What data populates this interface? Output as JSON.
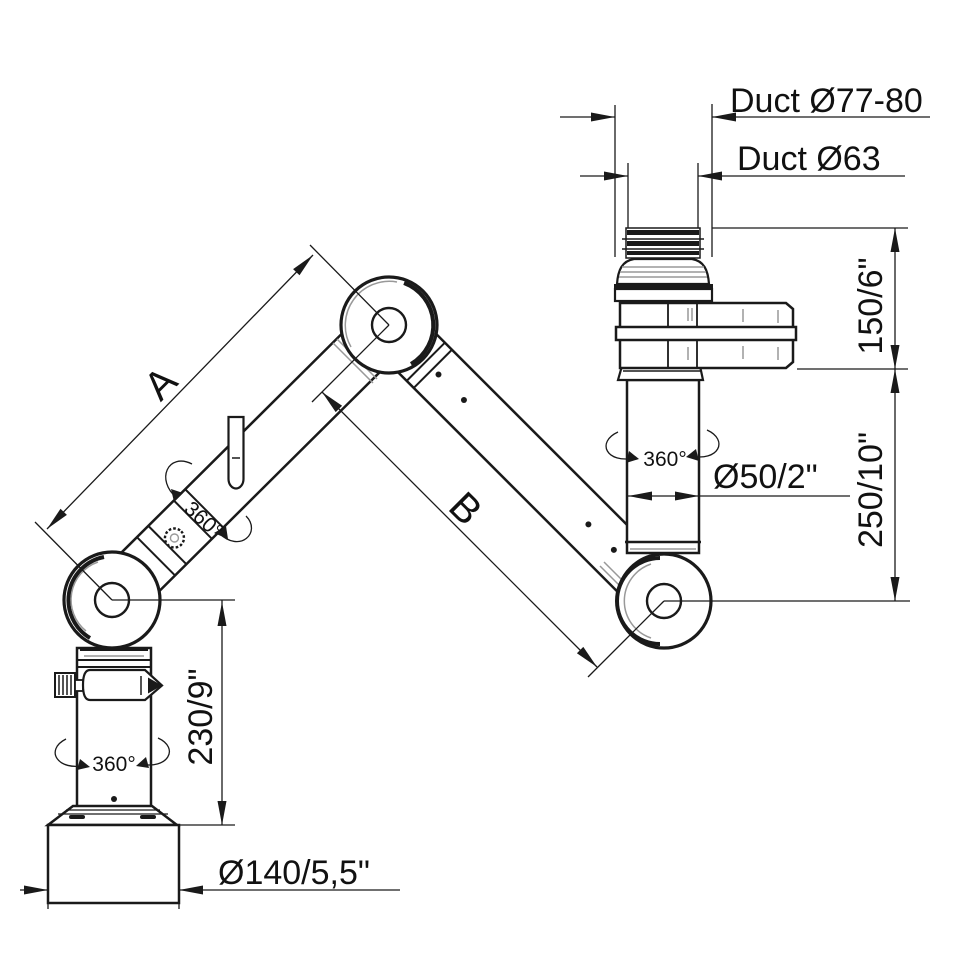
{
  "diagram": {
    "type": "technical dimensional drawing",
    "subject": "Articulated extraction arm with swivel joints",
    "background": "#ffffff",
    "line_color": "#1a1a1a",
    "shading_color": "#999999",
    "labels": {
      "duct_outer": "Duct Ø77-80",
      "duct_inner": "Duct Ø63",
      "top_height": "150/6\"",
      "mid_height": "250/10\"",
      "tube_diameter": "Ø50/2\"",
      "arm_upper": "A",
      "arm_lower": "B",
      "rotation": "360°",
      "column_height": "230/9\"",
      "base_diameter": "Ø140/5,5\""
    }
  }
}
